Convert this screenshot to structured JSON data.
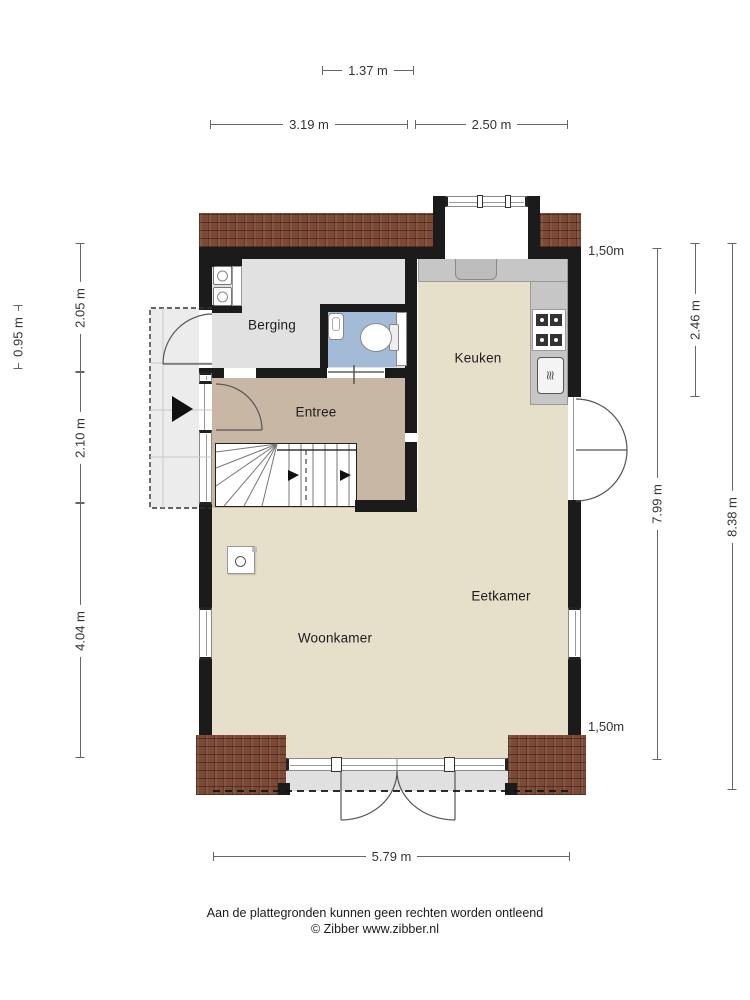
{
  "plan": {
    "rooms": {
      "berging": "Berging",
      "entree": "Entree",
      "keuken": "Keuken",
      "eetkamer": "Eetkamer",
      "woonkamer": "Woonkamer"
    },
    "dimensions": {
      "top_bay": "1.37 m",
      "top_left": "3.19 m",
      "top_right": "2.50 m",
      "left_porch": "0.95 m",
      "left_upper": "2.05 m",
      "left_middle": "2.10 m",
      "left_lower": "4.04 m",
      "right_overhang_top": "1,50m",
      "right_kitchen": "2.46 m",
      "right_inner": "7.99 m",
      "right_outer": "8.38 m",
      "right_overhang_bottom": "1,50m",
      "bottom_width": "5.79 m"
    }
  },
  "footer": {
    "disclaimer": "Aan de plattegronden kunnen geen rechten worden ontleend",
    "credit": "© Zibber www.zibber.nl"
  },
  "colors": {
    "wall": "#1b1b1b",
    "roof": "#7b4a36",
    "living": "#e6dfc9",
    "entree": "#c8b7a4",
    "berging": "#e1e1e1",
    "bath": "#a3bbd7",
    "counter": "#c6c6c6",
    "porch": "#ececec",
    "dimline": "#666666",
    "dimtext": "#333333"
  }
}
